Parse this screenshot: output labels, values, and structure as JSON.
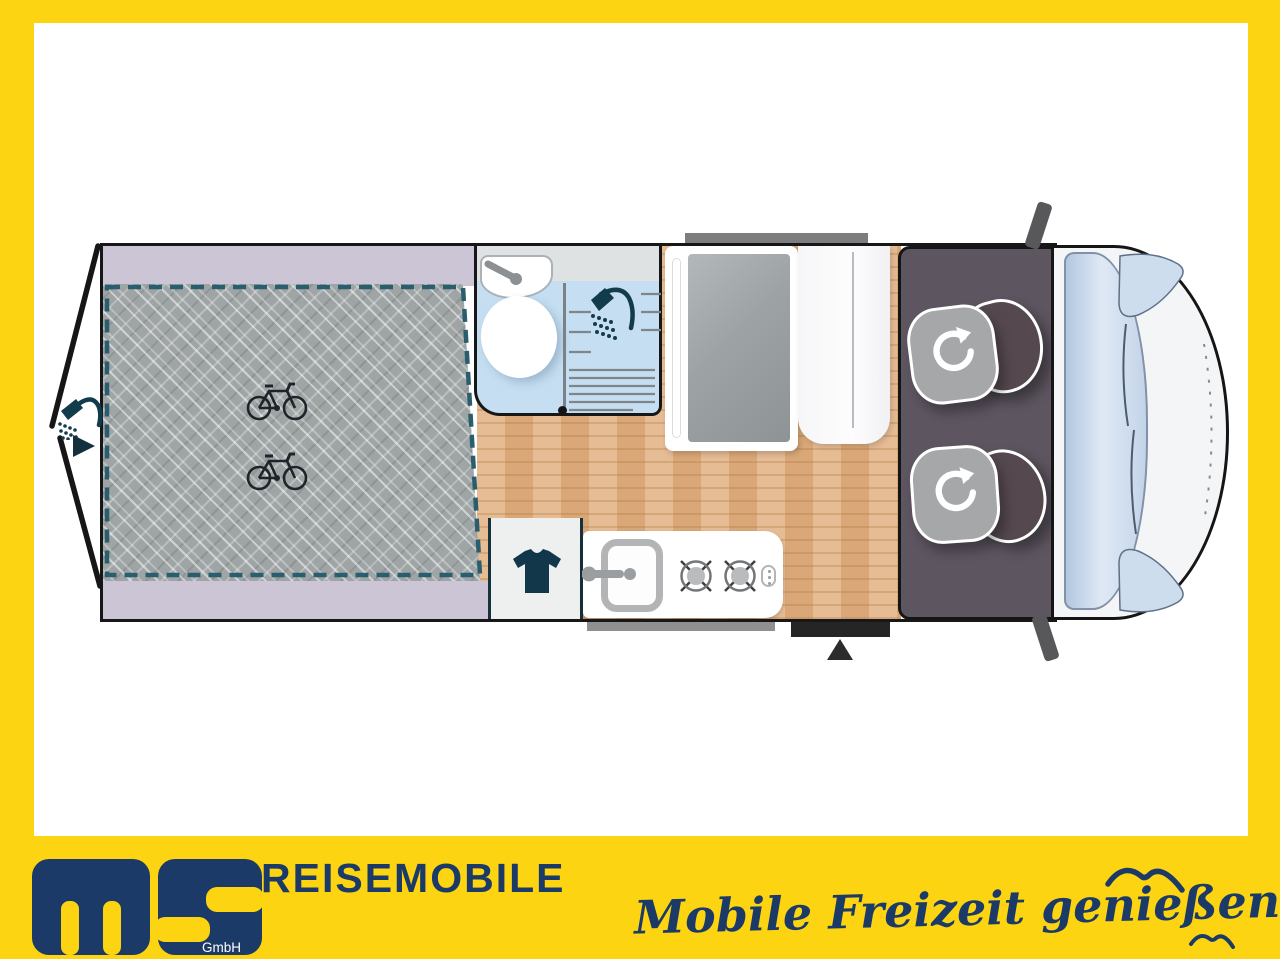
{
  "meta": {
    "description": "Camper van top-view floor plan advertisement banner"
  },
  "footer": {
    "brand": "REISEMOBILE",
    "company_suffix": "GmbH",
    "tagline": "Mobile Freizeit genießen."
  },
  "colors": {
    "frame_yellow": "#FCD411",
    "navy": "#1B3A67",
    "icon_teal": "#123C4C",
    "garage_dashed_teal": "#2A5D6E",
    "lavender_band": "#CBC5D6",
    "checker_gray": "#9FA4A4",
    "wood_floor": "#E2B184",
    "bathroom_blue": "#C5DEF1",
    "cab_gray": "#5D5560",
    "vehicle_front_white": "#F4F5F7",
    "windshield_blue": "#C3D4E8"
  },
  "floorplan": {
    "areas": [
      "rear-garage",
      "bathroom",
      "shower",
      "kitchen",
      "wardrobe",
      "corridor",
      "cab",
      "vehicle-front"
    ],
    "icons": [
      "bicycle-icon",
      "outdoor-shower-icon",
      "entry-arrow-icon",
      "washbasin-faucet-icon",
      "toilet-icon",
      "shower-head-icon",
      "wardrobe-tshirt-icon",
      "sink-faucet-icon",
      "gas-burner-icon",
      "swivel-seat-rotate-icon",
      "door-triangle-icon",
      "seagull-icon"
    ],
    "bike_count": 2,
    "burner_count": 2,
    "swivel_seat_count": 2
  }
}
